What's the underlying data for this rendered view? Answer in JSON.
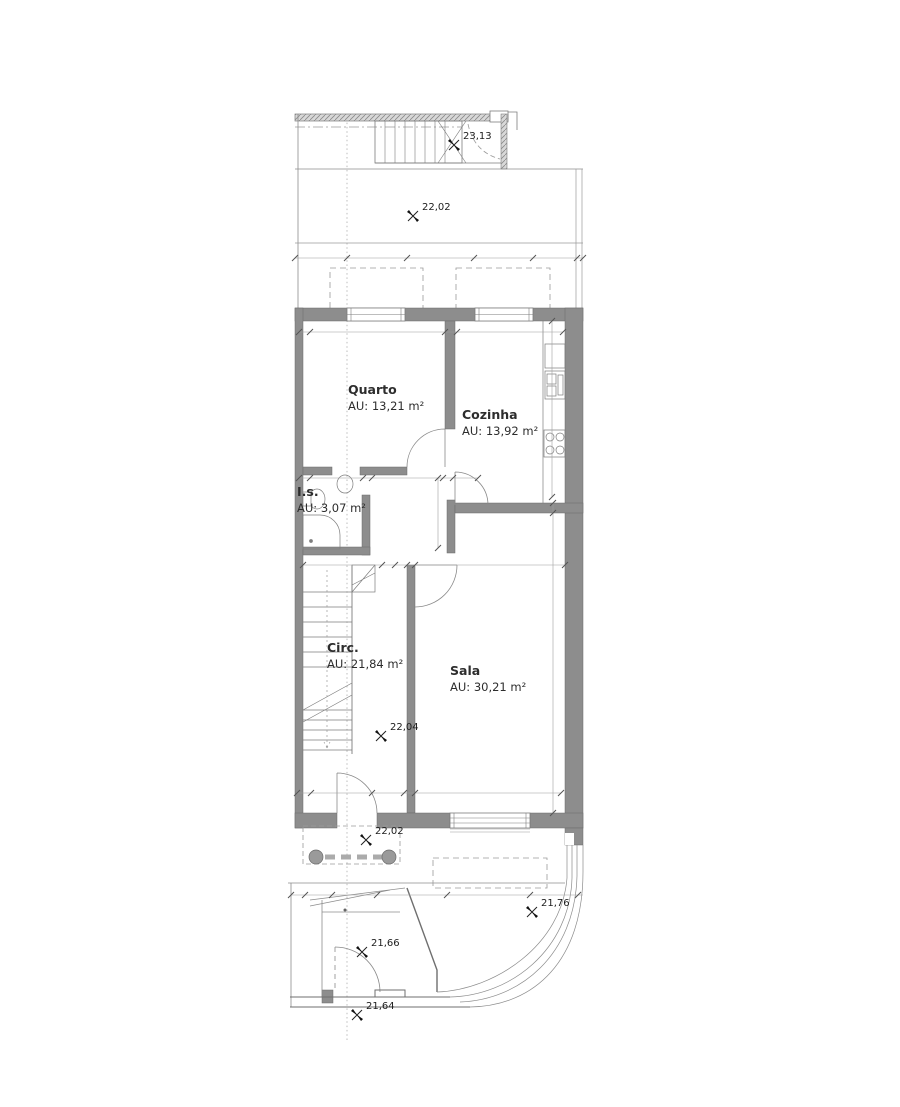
{
  "drawing_title": "floor-plan",
  "colors": {
    "wall": "#8d8d8d",
    "wall_edge": "#6b6b6b",
    "line": "#8c8c8c",
    "text": "#333333"
  },
  "rooms": [
    {
      "n": "Quarto",
      "a": "AU: 13,21 m²",
      "x": 348,
      "y": 382
    },
    {
      "n": "Cozinha",
      "a": "AU: 13,92 m²",
      "x": 462,
      "y": 407
    },
    {
      "n": "I.s.",
      "a": "AU: 3,07 m²",
      "x": 297,
      "y": 484
    },
    {
      "n": "Circ.",
      "a": "AU: 21,84 m²",
      "x": 327,
      "y": 640
    },
    {
      "n": "Sala",
      "a": "AU: 30,21 m²",
      "x": 450,
      "y": 663
    }
  ],
  "levels": [
    {
      "t": "23,13",
      "x": 463,
      "y": 131
    },
    {
      "t": "22,02",
      "x": 422,
      "y": 202
    },
    {
      "t": "22,04",
      "x": 390,
      "y": 722
    },
    {
      "t": "22,02",
      "x": 375,
      "y": 826
    },
    {
      "t": "21,76",
      "x": 541,
      "y": 898
    },
    {
      "t": "21,66",
      "x": 371,
      "y": 938
    },
    {
      "t": "21,64",
      "x": 366,
      "y": 1001
    }
  ],
  "dims": [
    {
      "t": "1,50",
      "x": 368,
      "y": 250
    },
    {
      "t": "1,80",
      "x": 431,
      "y": 250
    },
    {
      "t": "1,50",
      "x": 503,
      "y": 250
    },
    {
      "t": "1,20",
      "x": 556,
      "y": 250
    },
    {
      "t": "0,30",
      "x": 311,
      "y": 322
    },
    {
      "t": "3,67",
      "x": 388,
      "y": 322
    },
    {
      "t": "0,15",
      "x": 461,
      "y": 322
    },
    {
      "t": "2,93",
      "x": 517,
      "y": 322
    },
    {
      "t": "0,30",
      "x": 311,
      "y": 466
    },
    {
      "t": "1,50",
      "x": 341,
      "y": 466
    },
    {
      "t": "0,15",
      "x": 378,
      "y": 466
    },
    {
      "t": "2,02",
      "x": 414,
      "y": 466
    },
    {
      "t": "0,15",
      "x": 462,
      "y": 466
    },
    {
      "t": "2,60",
      "x": 345,
      "y": 553
    },
    {
      "t": "0,15",
      "x": 394,
      "y": 553
    },
    {
      "t": "4,30",
      "x": 493,
      "y": 553
    },
    {
      "t": "0,30",
      "x": 307,
      "y": 781
    },
    {
      "t": "2,60",
      "x": 352,
      "y": 781
    },
    {
      "t": "0,15",
      "x": 384,
      "y": 781
    },
    {
      "t": "4,00",
      "x": 489,
      "y": 781
    },
    {
      "t": "0,80",
      "x": 320,
      "y": 884
    },
    {
      "t": "1,00",
      "x": 356,
      "y": 884
    },
    {
      "t": "1,89",
      "x": 411,
      "y": 884
    },
    {
      "t": "2,12",
      "x": 489,
      "y": 884
    },
    {
      "t": "1,24",
      "x": 555,
      "y": 884
    }
  ],
  "vdims": [
    {
      "t": "4,75",
      "x": 549,
      "y": 412
    },
    {
      "t": "2,05",
      "x": 432,
      "y": 513
    },
    {
      "t": "0,15",
      "x": 549,
      "y": 519
    },
    {
      "t": "7,80",
      "x": 549,
      "y": 670
    }
  ],
  "small": [
    {
      "t": "40",
      "x": 302,
      "y": 235
    },
    {
      "t": "0",
      "x": 299,
      "y": 255
    },
    {
      "t": "30",
      "x": 295,
      "y": 882,
      "c": "m8"
    },
    {
      "t": "\"J\"",
      "x": 352,
      "y": 834,
      "c": "mj"
    },
    {
      "t": "3",
      "x": 400,
      "y": 881,
      "c": "mt"
    },
    {
      "t": "1",
      "x": 405,
      "y": 902,
      "c": "mt"
    },
    {
      "t": "14",
      "x": 341,
      "y": 596,
      "c": "mst"
    },
    {
      "t": "13",
      "x": 341,
      "y": 611,
      "c": "mst"
    },
    {
      "t": "12",
      "x": 341,
      "y": 626,
      "c": "mst"
    },
    {
      "t": "11",
      "x": 341,
      "y": 641,
      "c": "mst"
    },
    {
      "t": "10",
      "x": 341,
      "y": 656,
      "c": "mst"
    },
    {
      "t": "15",
      "x": 388,
      "y": 157,
      "c": "mstv"
    },
    {
      "t": "16",
      "x": 398,
      "y": 157,
      "c": "mstv"
    },
    {
      "t": "17",
      "x": 408,
      "y": 157,
      "c": "mstv"
    },
    {
      "t": "18",
      "x": 418,
      "y": 157,
      "c": "mstv"
    },
    {
      "t": "19",
      "x": 428,
      "y": 157,
      "c": "mstv"
    },
    {
      "t": "20",
      "x": 438,
      "y": 157,
      "c": "mstv"
    },
    {
      "t": "16x0,18",
      "x": 324,
      "y": 662,
      "c": "mann"
    },
    {
      "t": "ML",
      "x": 556,
      "y": 356,
      "c": "mml"
    }
  ]
}
